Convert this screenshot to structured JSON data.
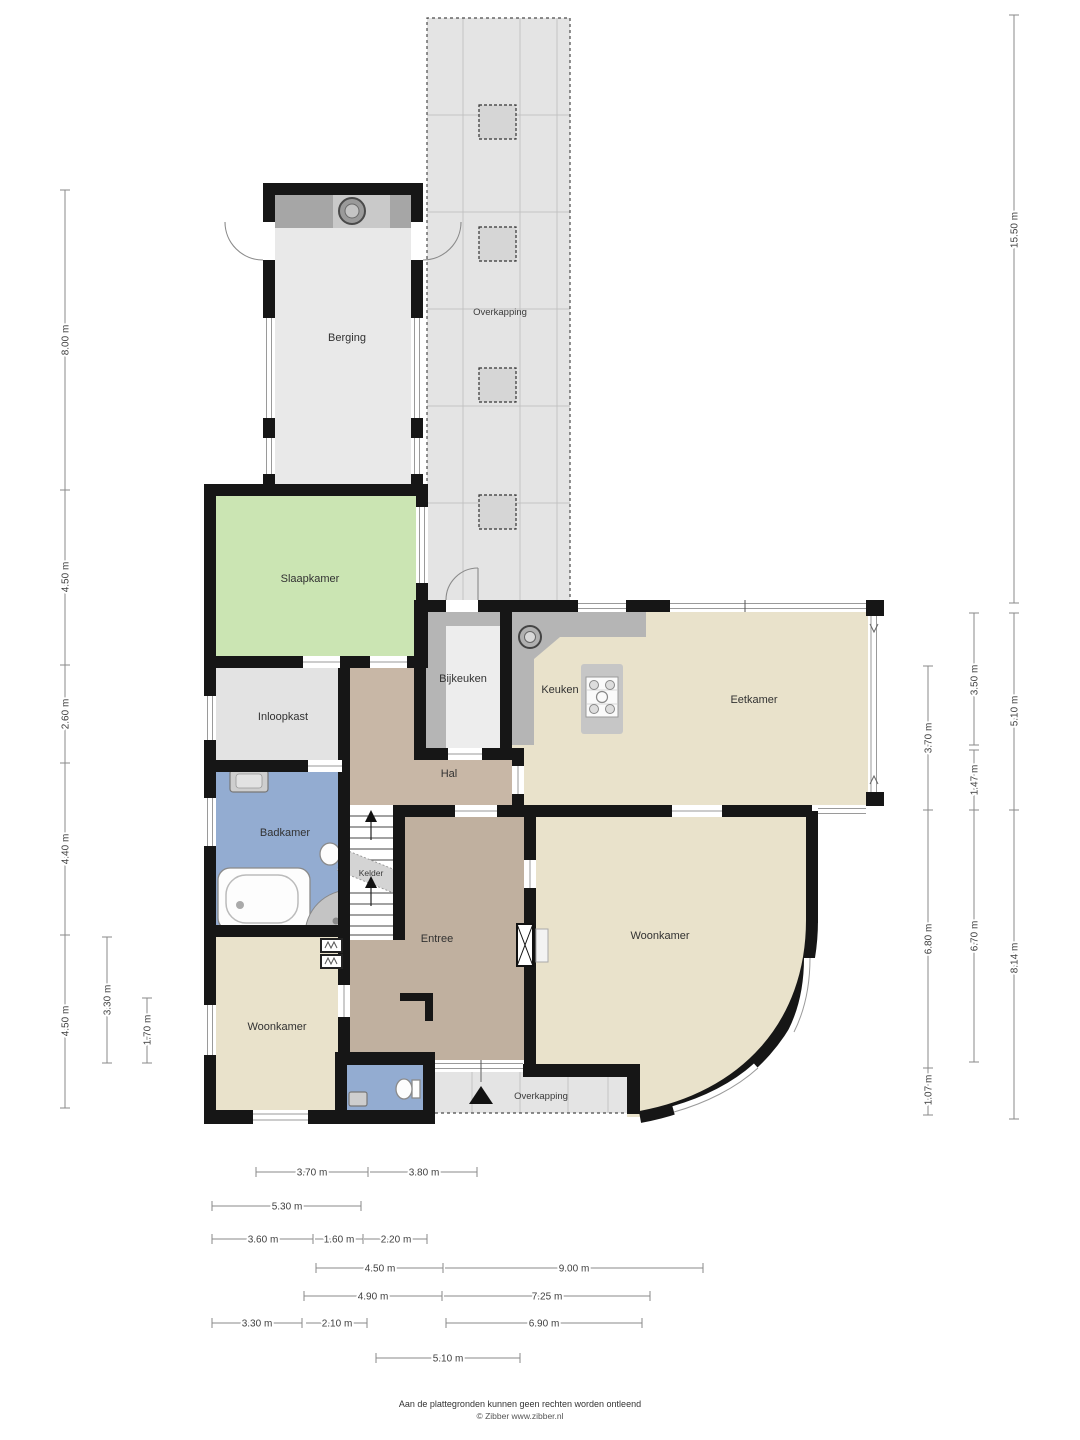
{
  "labels": {
    "berging": "Berging",
    "overkapping": "Overkapping",
    "slaapkamer": "Slaapkamer",
    "inloopkast": "Inloopkast",
    "badkamer": "Badkamer",
    "bijkeuken": "Bijkeuken",
    "keuken": "Keuken",
    "eetkamer": "Eetkamer",
    "hal": "Hal",
    "kelder": "Kelder",
    "entree": "Entree",
    "woonkamer": "Woonkamer"
  },
  "dims_vertical": [
    "8.00 m",
    "4.50 m",
    "2.60 m",
    "4.40 m",
    "4.50 m",
    "3.30 m",
    "1.70 m",
    "15.50 m",
    "5.10 m",
    "8.14 m",
    "3.50 m",
    "1.47 m",
    "6.70 m",
    "3.70 m",
    "6.80 m",
    "1.07 m"
  ],
  "dims_horizontal": [
    "3.70 m",
    "3.80 m",
    "5.30 m",
    "3.60 m",
    "1.60 m",
    "2.20 m",
    "4.50 m",
    "9.00 m",
    "4.90 m",
    "7.25 m",
    "3.30 m",
    "2.10 m",
    "6.90 m",
    "5.10 m"
  ],
  "footer": {
    "line1": "Aan de plattegronden kunnen geen rechten worden ontleend",
    "line2": "© Zibber www.zibber.nl"
  },
  "colors": {
    "wall": "#161616",
    "cream": "#e9e2cb",
    "hal_tan": "#c8b7a6",
    "entree_tan": "#c0b09f",
    "green": "#cbe5b3",
    "blue": "#93acd1",
    "grey_room": "#e3e3e3",
    "berging_grey": "#e9e9e9",
    "counter": "#b5b5b5",
    "overkapping": "#e4e4e4"
  }
}
